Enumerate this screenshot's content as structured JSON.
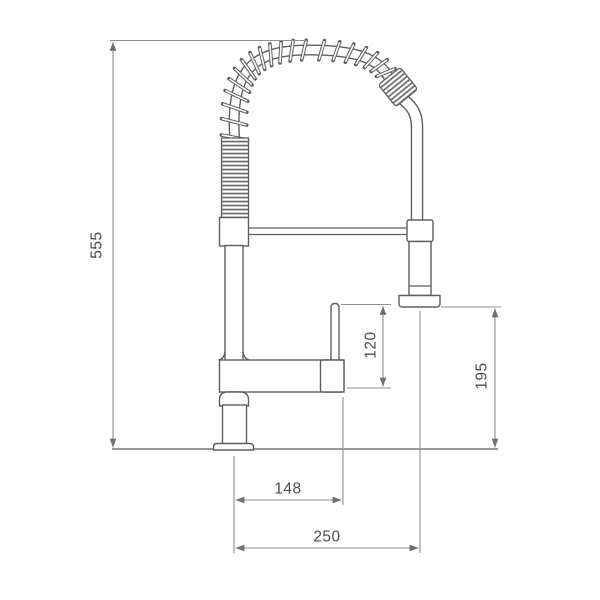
{
  "drawing": {
    "type": "technical-dimension-drawing",
    "subject": "pull-down spring kitchen faucet, front elevation",
    "dimensions": [
      {
        "id": "total-height",
        "value": "555",
        "orientation": "vertical",
        "measures": "counter line to top of spring spout"
      },
      {
        "id": "lever-height",
        "value": "120",
        "orientation": "vertical",
        "measures": "spout arm to top of lever handle"
      },
      {
        "id": "spray-face-height",
        "value": "195",
        "orientation": "vertical",
        "measures": "counter line to spray head face"
      },
      {
        "id": "spout-reach",
        "value": "148",
        "orientation": "horizontal",
        "measures": "body centerline to end of spout arm"
      },
      {
        "id": "spray-reach",
        "value": "250",
        "orientation": "horizontal",
        "measures": "body centerline to spray head centerline"
      }
    ],
    "colors": {
      "background": "#ffffff",
      "outline": "#5f5f5f",
      "dimension_lines": "#8f8f8f",
      "dimension_text": "#4d4d4d",
      "counter_line": "#9a9a9a"
    }
  }
}
